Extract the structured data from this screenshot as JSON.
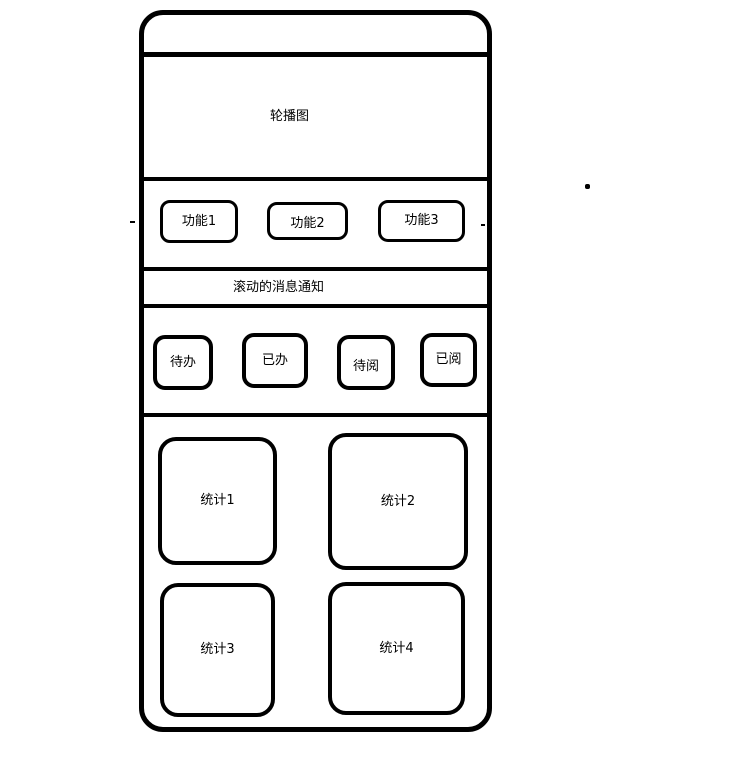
{
  "canvas": {
    "background": "#ffffff",
    "stroke": "#000000"
  },
  "phone": {
    "carousel": {
      "label": "轮播图"
    },
    "quick_actions": [
      {
        "label": "功能1"
      },
      {
        "label": "功能2"
      },
      {
        "label": "功能3"
      }
    ],
    "notice_bar": {
      "label": "滚动的消息通知"
    },
    "tabs": [
      {
        "label": "待办"
      },
      {
        "label": "已办"
      },
      {
        "label": "待阅"
      },
      {
        "label": "已阅"
      }
    ],
    "stats": [
      {
        "label": "统计1"
      },
      {
        "label": "统计2"
      },
      {
        "label": "统计3"
      },
      {
        "label": "统计4"
      }
    ]
  }
}
